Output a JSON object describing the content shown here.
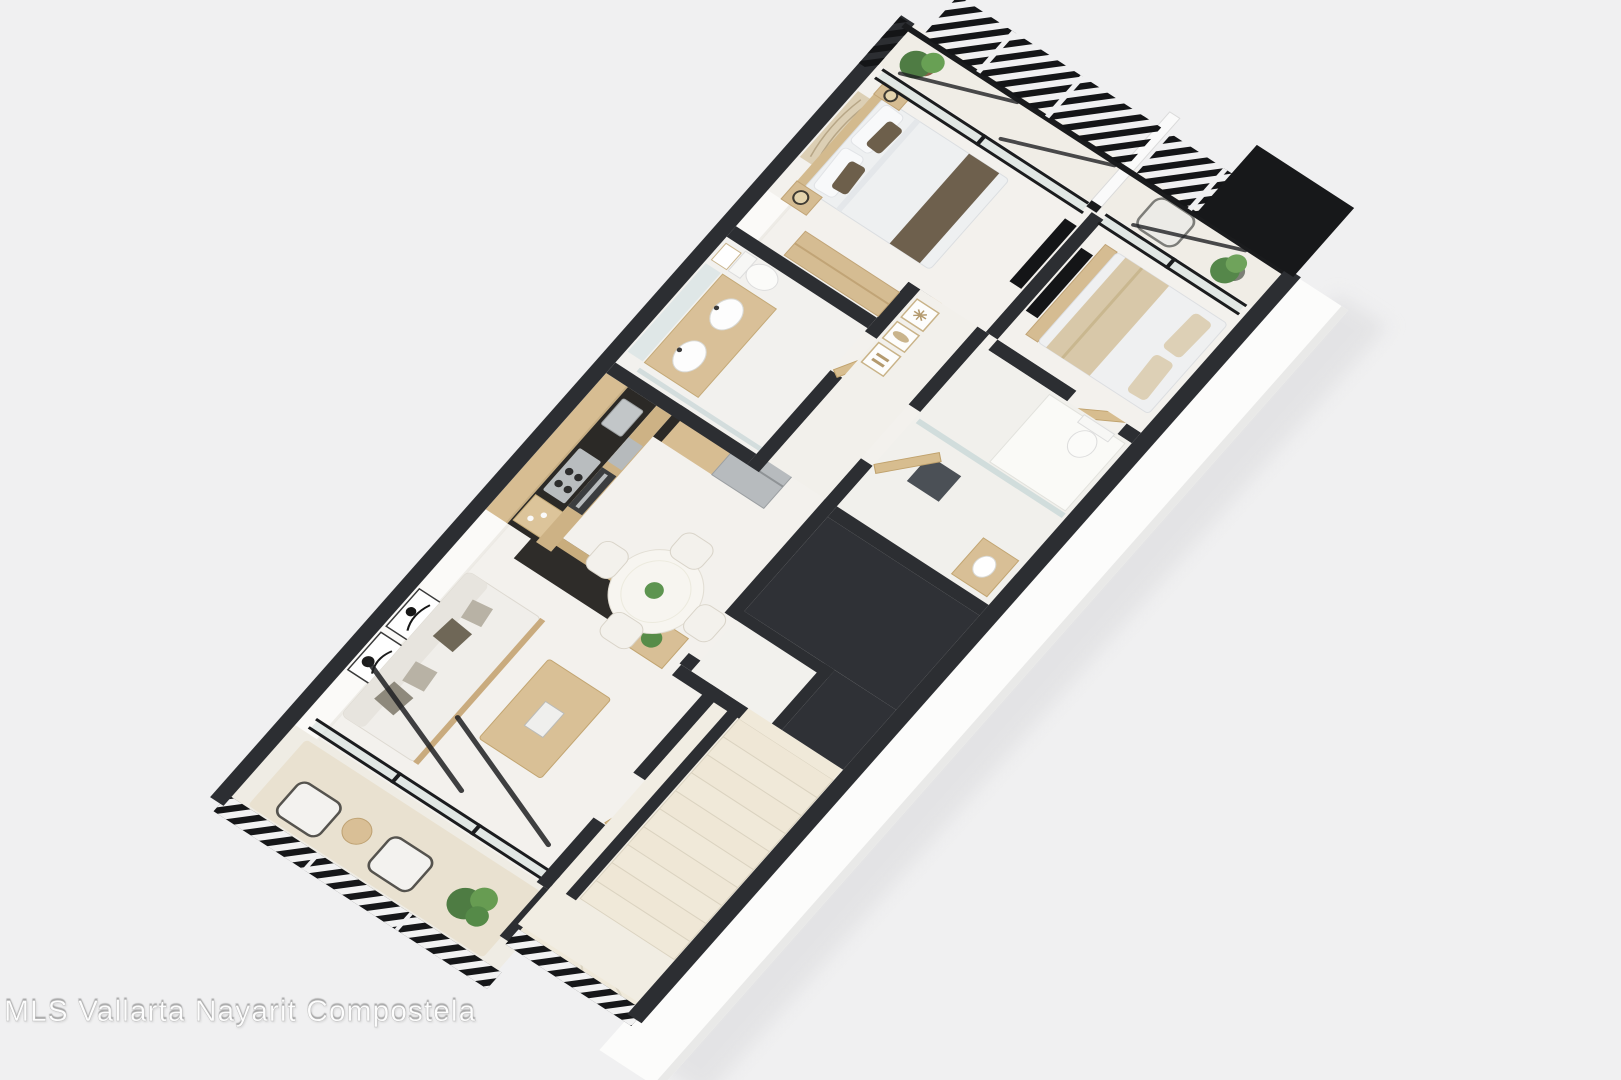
{
  "watermark": {
    "text": "MLS Vallarta Nayarit Compostela"
  },
  "scene": {
    "type": "3d-isometric-floor-plan",
    "rooms": [
      "balcony-terrace",
      "living-room",
      "dining-area",
      "kitchen",
      "entry-stair-hall",
      "staircase",
      "storage-closet",
      "utility-void",
      "main-bathroom",
      "hallway",
      "second-bathroom",
      "wardrobe",
      "master-bedroom",
      "master-balcony",
      "second-bedroom",
      "second-balcony",
      "roof-section"
    ]
  },
  "palette": {
    "background": "#f0f0f1",
    "walls_dark": "#2c2e32",
    "floor_light": "#f3f1ed",
    "wood": "#d7bd92",
    "wood_dark": "#c2a571",
    "counter_dark": "#2b2926",
    "stainless": "#b9bdc0",
    "linen_white": "#eff0f1",
    "linen_brown": "#6d5f4b",
    "linen_beige": "#d8c8a9",
    "plant_green": "#55874a",
    "metal_black": "#1a1b1d",
    "glass": "#d7e2df",
    "tread_beige": "#f0e9d9",
    "watermark_text": "#fdfdfd"
  }
}
